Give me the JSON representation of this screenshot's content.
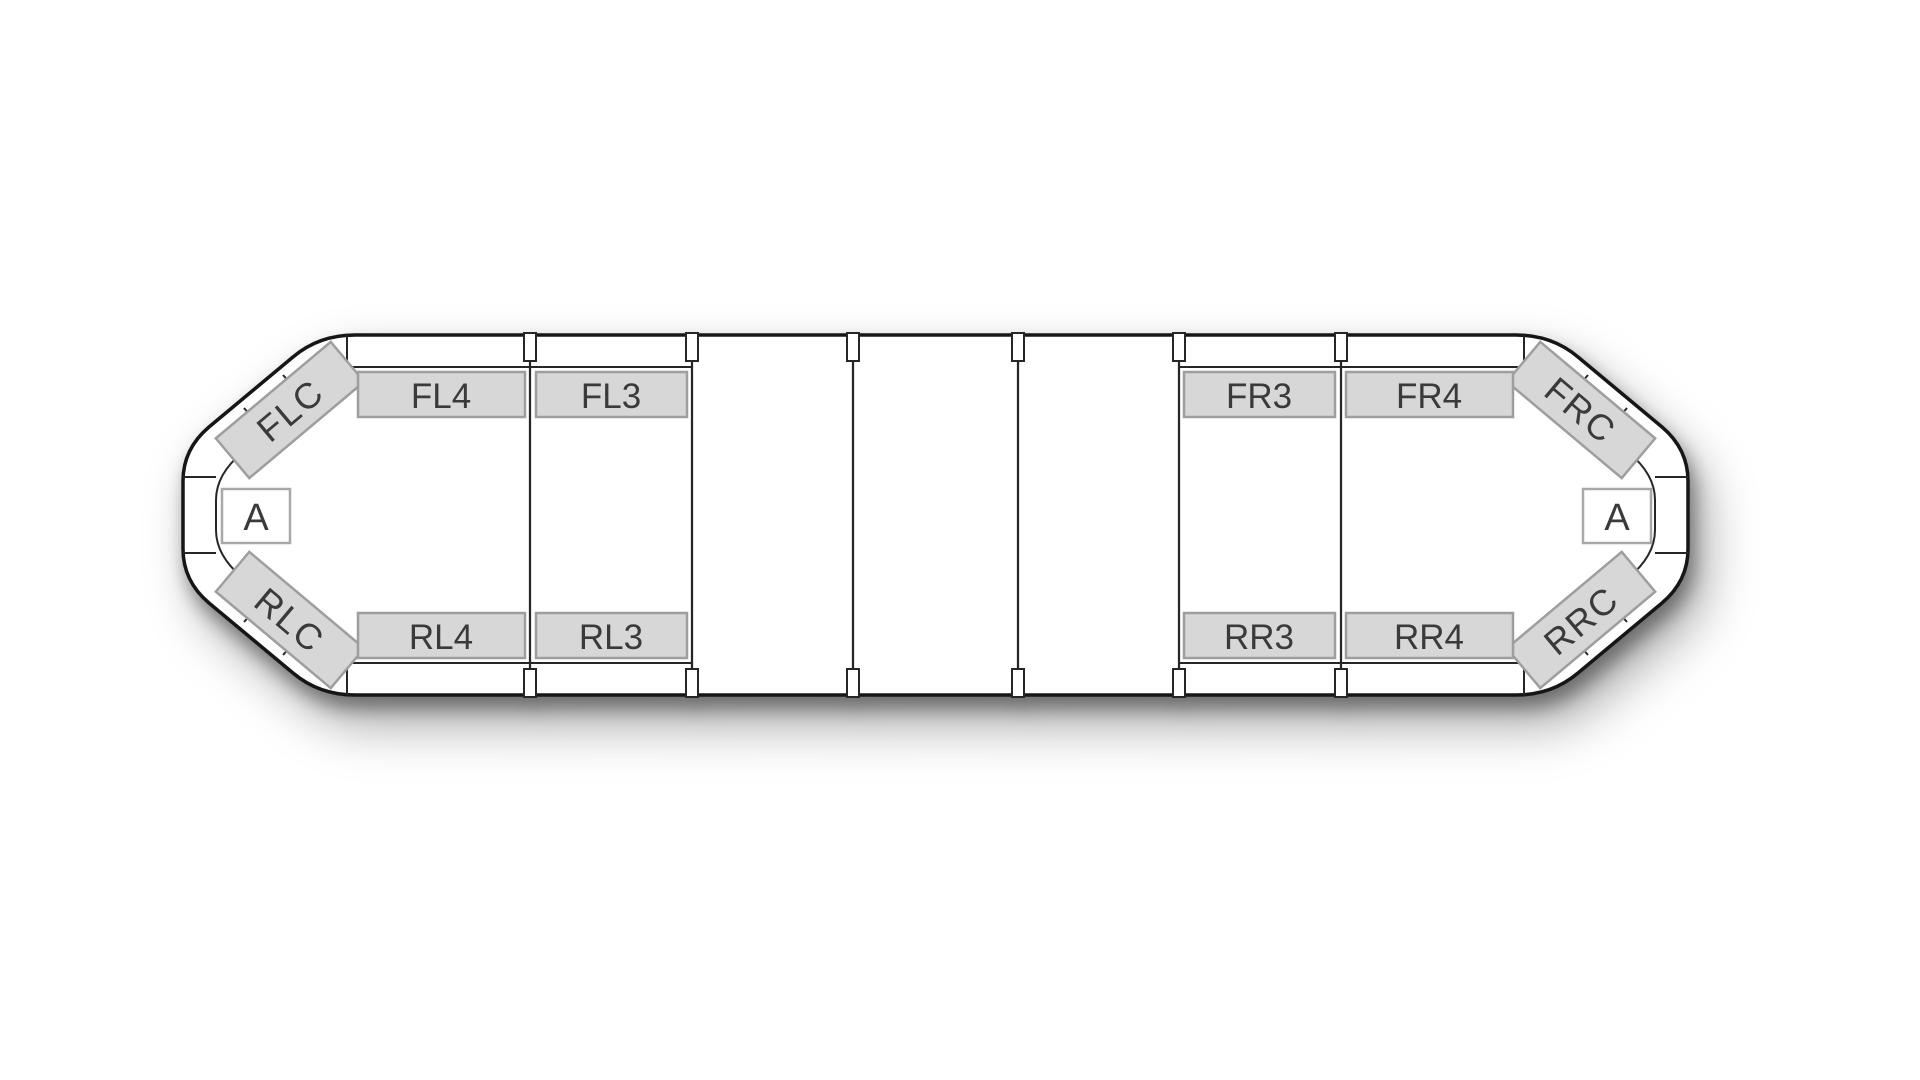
{
  "lightbar": {
    "front_row": {
      "left_corner": "FLC",
      "left_modules": [
        "FL4",
        "FL3"
      ],
      "right_modules": [
        "FR3",
        "FR4"
      ],
      "right_corner": "FRC"
    },
    "rear_row": {
      "left_corner": "RLC",
      "left_modules": [
        "RL4",
        "RL3"
      ],
      "right_modules": [
        "RR3",
        "RR4"
      ],
      "right_corner": "RRC"
    },
    "left_end_label": "A",
    "right_end_label": "A",
    "empty_center_sections": 3,
    "colors": {
      "module_fill": "#d7d7d7",
      "module_border": "#9e9e9e",
      "outline": "#161616",
      "line": "#262626",
      "label_text": "#3a3a3a",
      "end_box_fill": "#ffffff",
      "background": "#ffffff"
    }
  }
}
